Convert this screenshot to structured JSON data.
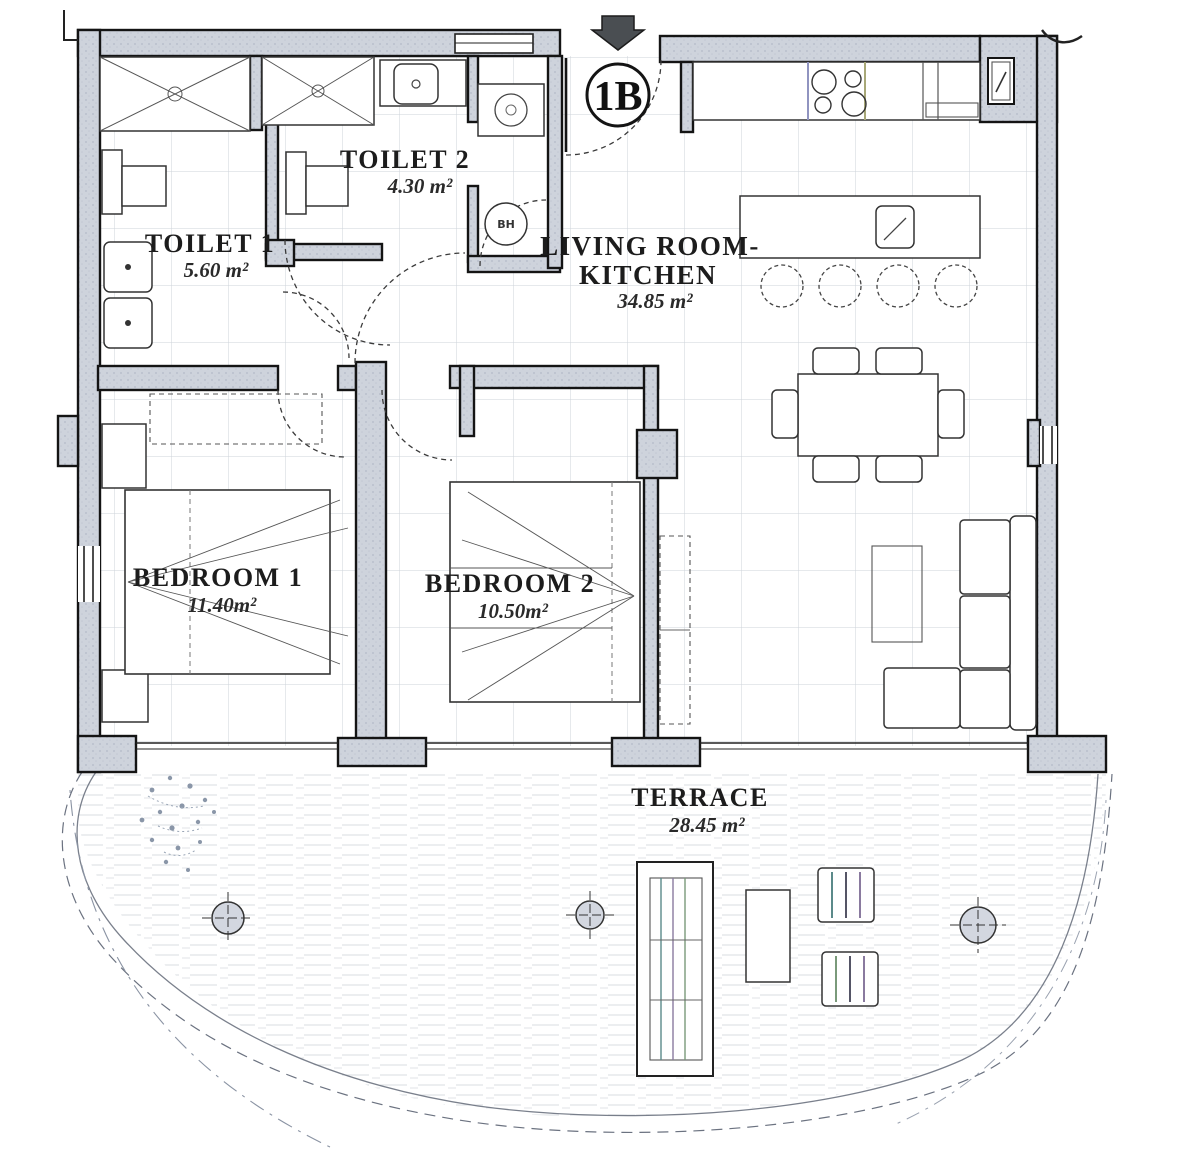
{
  "plan": {
    "unit_badge": "1B",
    "rooms": {
      "toilet1": {
        "name": "TOILET 1",
        "area": "5.60 m²"
      },
      "toilet2": {
        "name": "TOILET 2",
        "area": "4.30 m²"
      },
      "living_kitchen": {
        "name_line1": "LIVING ROOM-",
        "name_line2": "KITCHEN",
        "area": "34.85 m²"
      },
      "bedroom1": {
        "name": "BEDROOM 1",
        "area": "11.40m²"
      },
      "bedroom2": {
        "name": "BEDROOM 2",
        "area": "10.50m²"
      },
      "terrace": {
        "name": "TERRACE",
        "area": "28.45 m²"
      }
    },
    "labels": {
      "water_heater": "BH"
    },
    "colors": {
      "wall_fill": "#ced3dc",
      "line": "#141414",
      "grid": "#cdd3da",
      "deck_hatch": "#d8dce1",
      "scan_tint_teal": "#5b8a8a",
      "scan_tint_purple": "#8a7a9f",
      "scan_tint_green": "#7a9a7a"
    }
  }
}
